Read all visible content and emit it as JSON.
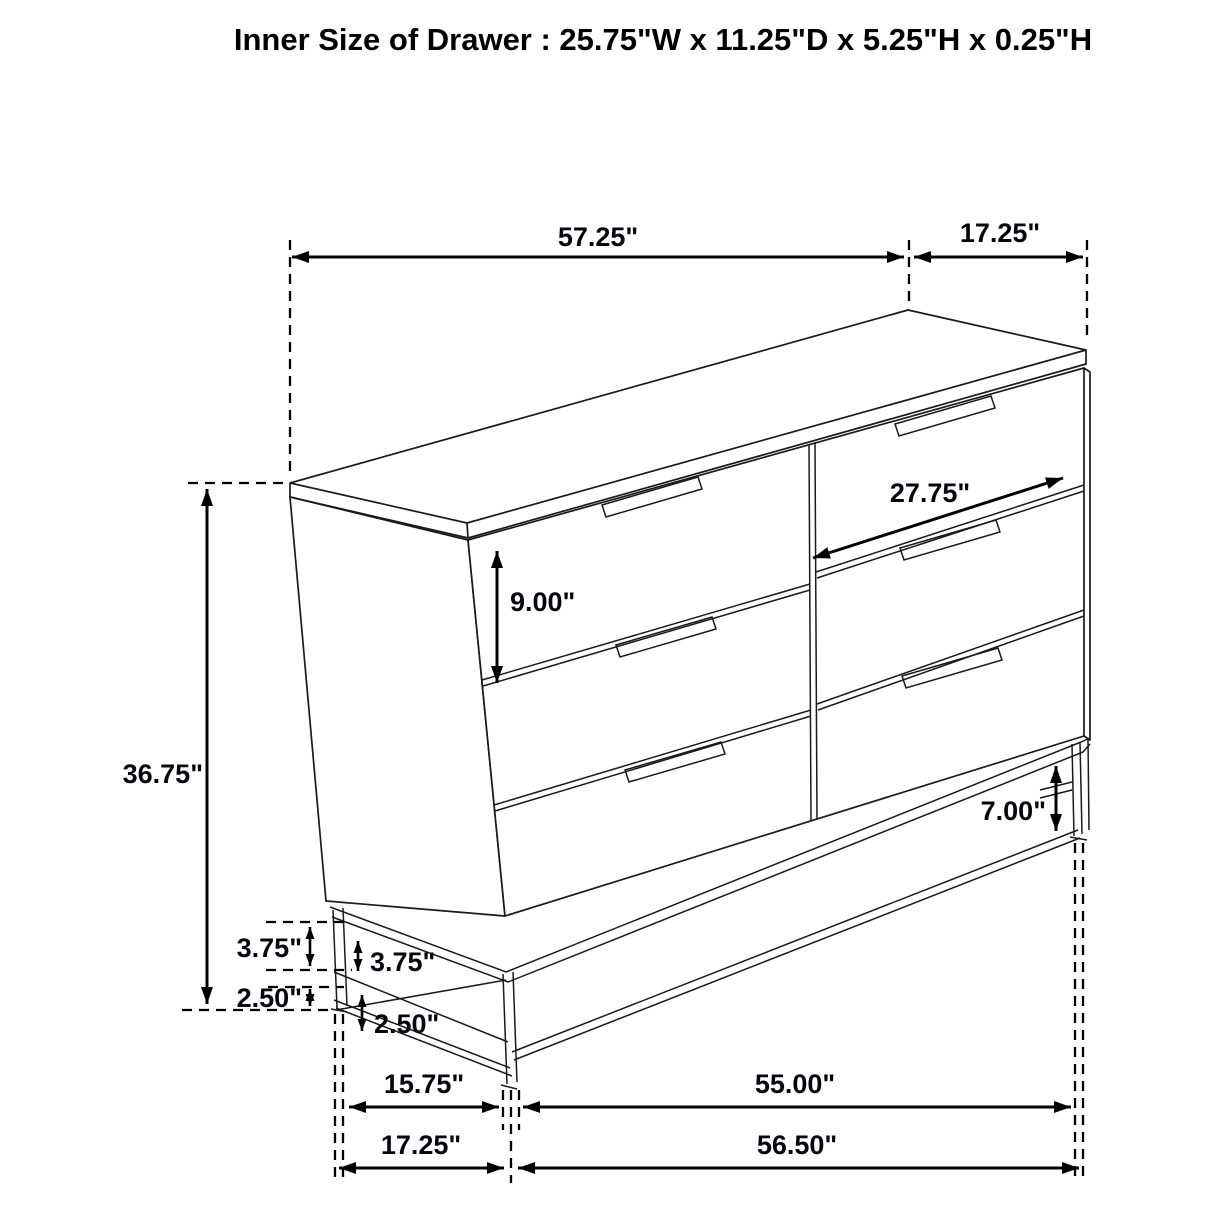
{
  "title": "Inner Size of Drawer : 25.75\"W x 11.25\"D x 5.25\"H x 0.25\"H",
  "drawing_subject": "six-drawer dresser dimensional line drawing",
  "dimensions": {
    "top_width": "57.25\"",
    "top_depth": "17.25\"",
    "drawer_face_width": "27.75\"",
    "drawer_face_height": "9.00\"",
    "overall_height": "36.75\"",
    "base_clearance": "7.00\"",
    "base_upper_outer": "3.75\"",
    "base_lower_outer": "2.50\"",
    "base_upper_inner": "3.75\"",
    "base_lower_inner": "2.50\"",
    "bottom_depth_inner": "15.75\"",
    "bottom_width_inner": "55.00\"",
    "bottom_depth_outer": "17.25\"",
    "bottom_width_outer": "56.50\""
  }
}
